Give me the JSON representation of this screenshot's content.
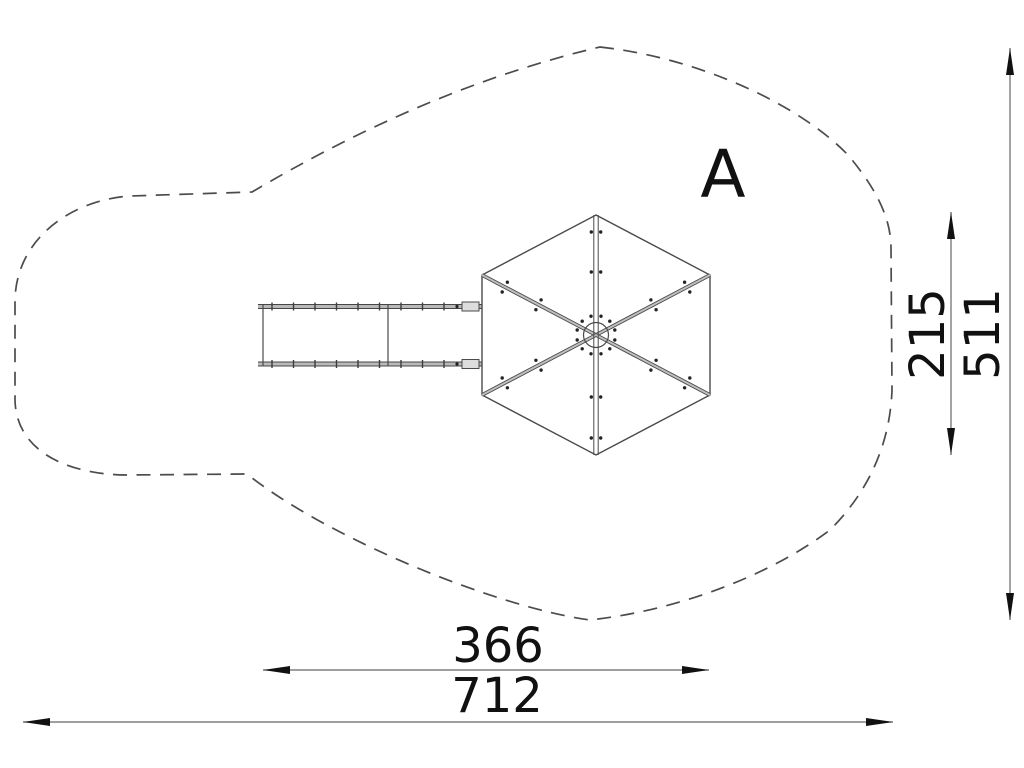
{
  "drawing": {
    "area_label": "A",
    "dimensions": {
      "structure_width": "366",
      "total_width": "712",
      "structure_depth": "215",
      "total_depth": "511"
    },
    "colors": {
      "outline_dash": "#4c4c4c",
      "structure_line": "#4a4a4a",
      "structure_fill": "#bfbfbf",
      "dimension_line": "#666666",
      "arrow": "#111111",
      "text": "#111111",
      "background": "#ffffff"
    }
  }
}
